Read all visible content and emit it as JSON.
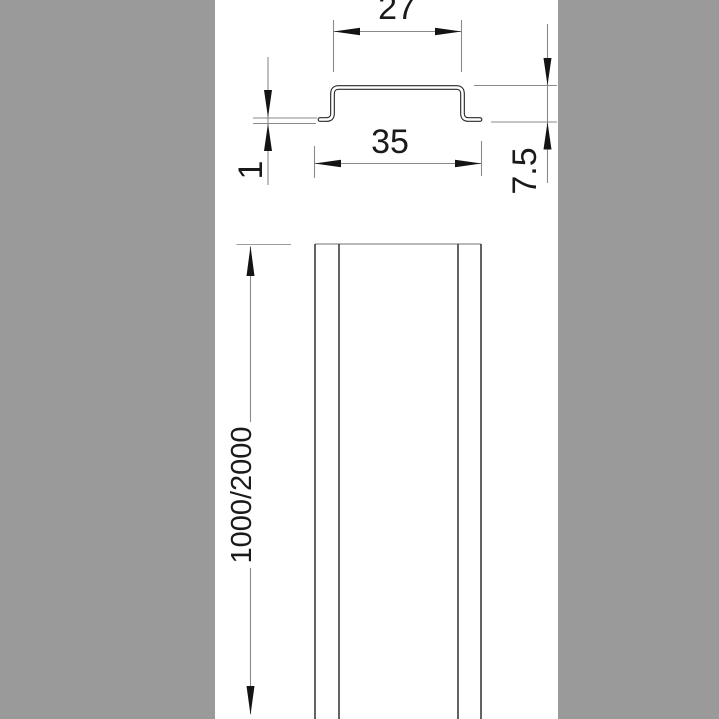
{
  "colors": {
    "panel": "#9a9a9a",
    "canvas": "#ffffff",
    "outline": "#2b2b2b",
    "thin_line": "#8a8a8a",
    "arrow": "#141414",
    "text": "#1a1a1a"
  },
  "drawing_type": "technical-dimension-drawing",
  "dimensions": {
    "top_width": {
      "label": "27"
    },
    "overall_width": {
      "label": "35"
    },
    "material_thickness": {
      "label": "1"
    },
    "profile_height": {
      "label": "7.5"
    },
    "rail_length": {
      "label": "1000/2000"
    }
  }
}
